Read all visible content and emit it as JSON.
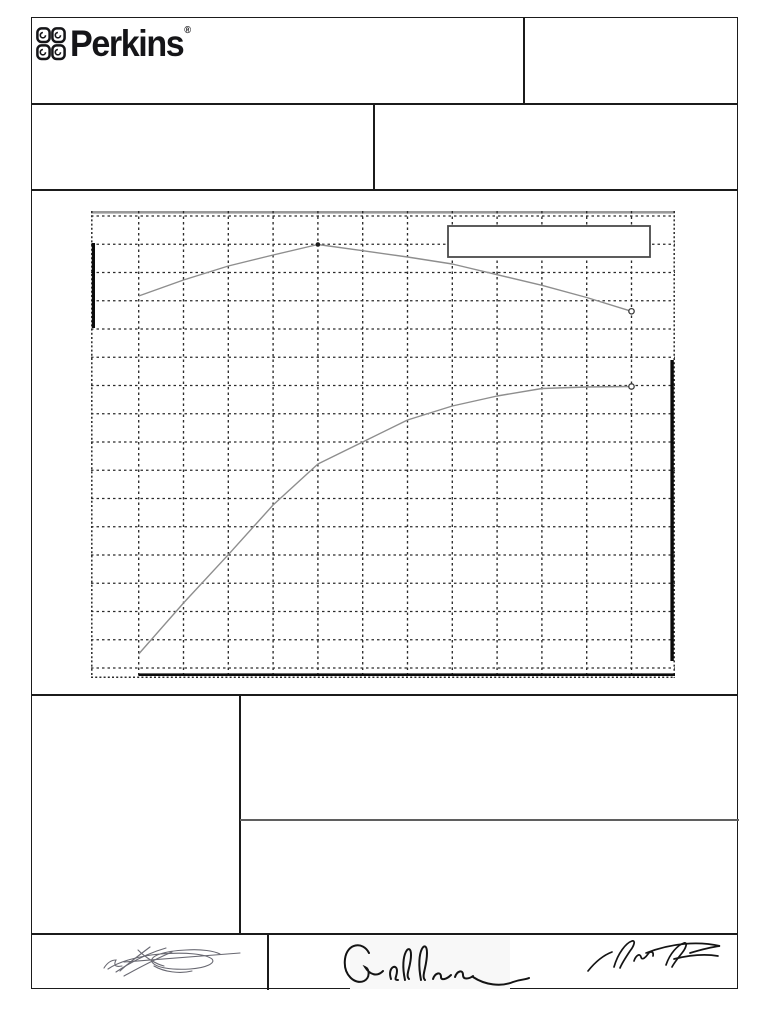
{
  "document": {
    "kind": "scanned performance curve sheet",
    "background": "#ffffff",
    "border_color": "#1b1b1b"
  },
  "brand": {
    "name": "Perkins",
    "registered_mark": "®",
    "logo_color": "#151518"
  },
  "header": {
    "logo_cell_text": "",
    "top_right_cell_text": "",
    "row2_left_cell_text": "",
    "row2_right_cell_text": ""
  },
  "lower_section": {
    "left_cell_text": "",
    "right_upper_cell_text": "",
    "right_lower_cell_text": ""
  },
  "footer": {
    "signatures": [
      {
        "name": "handwritten-signature-left",
        "legible_text": ""
      },
      {
        "name": "handwritten-signature-middle",
        "legible_text": ""
      },
      {
        "name": "handwritten-signature-right",
        "legible_text": ""
      }
    ]
  },
  "chart_data": {
    "type": "line",
    "title": "",
    "xlabel": "",
    "ylabel": "",
    "axis_tick_labels": [],
    "legend": {
      "box_visible": true,
      "entries": []
    },
    "grid": {
      "style": "dashed",
      "columns": 13,
      "rows": 16,
      "color": "#2b2b2b"
    },
    "plot_px": {
      "width": 584,
      "height": 467,
      "x_gridline_start": 47.7,
      "x_gridline_step": 44.8,
      "x_gridline_count": 12,
      "y_gridline_start": 5,
      "y_gridline_step": 28.25,
      "y_gridline_count": 17,
      "border_style": "dotted",
      "top_edge_color": "#9a9a9a"
    },
    "series": [
      {
        "name": "upper-curve",
        "color": "#8e8e8e",
        "points_px": [
          [
            47.7,
            85
          ],
          [
            92.5,
            69
          ],
          [
            137.3,
            55
          ],
          [
            182.1,
            44
          ],
          [
            226.9,
            33.5
          ],
          [
            271.7,
            39.7
          ],
          [
            316.5,
            46
          ],
          [
            361.3,
            53
          ],
          [
            406.1,
            63.7
          ],
          [
            450.9,
            74.3
          ],
          [
            495.7,
            86.5
          ],
          [
            540.5,
            100.3
          ]
        ],
        "markers": [
          {
            "type": "filled-dot",
            "at_px": [
              226.9,
              33.5
            ]
          },
          {
            "type": "open-circle",
            "at_px": [
              540.5,
              100.3
            ]
          }
        ]
      },
      {
        "name": "lower-curve",
        "color": "#8e8e8e",
        "points_px": [
          [
            47.7,
            443
          ],
          [
            92.5,
            392
          ],
          [
            137.3,
            343.7
          ],
          [
            182.1,
            294
          ],
          [
            226.9,
            253
          ],
          [
            271.7,
            231
          ],
          [
            316.5,
            209
          ],
          [
            361.3,
            195
          ],
          [
            406.1,
            185
          ],
          [
            450.9,
            177.5
          ],
          [
            495.7,
            176
          ],
          [
            540.5,
            175.5
          ]
        ],
        "markers": [
          {
            "type": "open-circle",
            "at_px": [
              540.5,
              175.5
            ]
          }
        ]
      }
    ],
    "annotations": {
      "left_axis_scale_bar_px": {
        "x": 0.8,
        "y1": 32,
        "y2": 117,
        "width": 3.2,
        "color": "#0b0b0b"
      },
      "right_axis_scale_bar_px": {
        "x": 579.4,
        "y1": 149,
        "y2": 450,
        "width": 3.4,
        "color": "#0b0b0b"
      },
      "bottom_baseline_px": {
        "x1": 47.7,
        "x2": 584,
        "y": 462.4,
        "height": 2.6,
        "color": "#0b0b0b"
      },
      "legend_box_px": {
        "x": 357,
        "y": 15,
        "width": 202,
        "height": 31,
        "border_color": "#4a4a4a",
        "fill": "#ffffff"
      }
    }
  }
}
